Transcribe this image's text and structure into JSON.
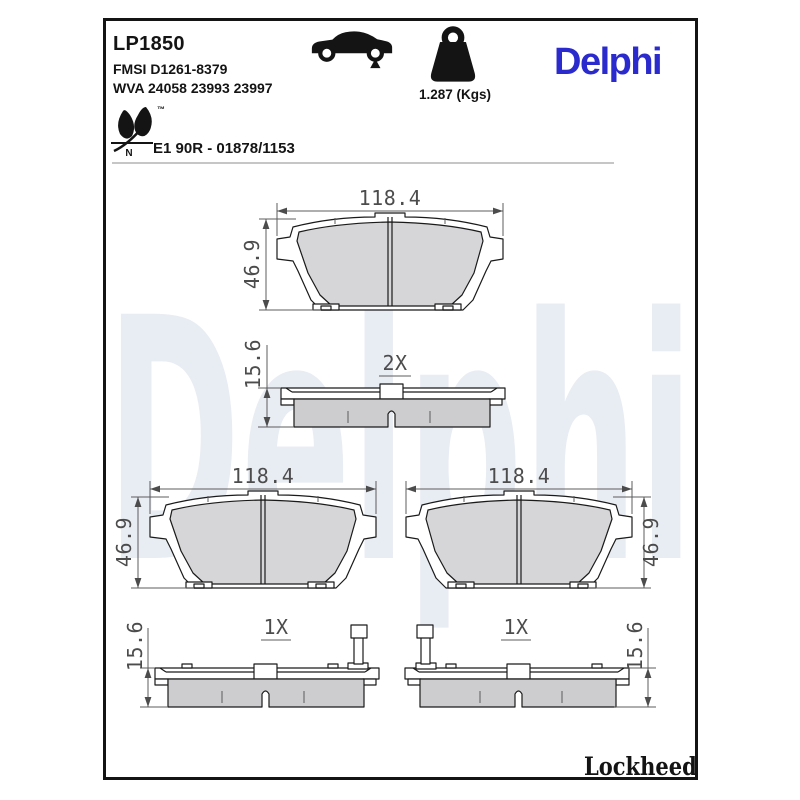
{
  "header": {
    "part_number": "LP1850",
    "fmsi_code": "FMSI D1261-8379",
    "wva_code": "WVA 24058 23993 23997",
    "weight": "1.287 (Kgs)",
    "brand_logo": "Delphi",
    "approval_code": "E1 90R - 01878/1153",
    "eco_trademark": "™",
    "eco_letter": "N"
  },
  "watermark": {
    "text": "Delphi"
  },
  "footer": {
    "brand": "Lockheed",
    "registered_mark": "®"
  },
  "drawings": {
    "pad_views": [
      {
        "position": "top-center",
        "width_mm": "118.4",
        "height_mm": "46.9"
      },
      {
        "position": "bottom-left",
        "width_mm": "118.4",
        "height_mm": "46.9"
      },
      {
        "position": "bottom-right",
        "width_mm": "118.4",
        "height_mm": "46.9"
      }
    ],
    "profile_views": [
      {
        "position": "middle",
        "thickness_mm": "15.6",
        "quantity": "2X"
      },
      {
        "position": "bottom-left",
        "thickness_mm": "15.6",
        "quantity": "1X"
      },
      {
        "position": "bottom-right",
        "thickness_mm": "15.6",
        "quantity": "1X"
      }
    ]
  },
  "icons": {
    "car": "car-silhouette-icon with rear-axle marker triangle",
    "weight": "weight-kettlebell-icon",
    "eco": "leaf-eco-icon"
  },
  "colors": {
    "brand_blue": "#2B2BCD",
    "watermark_gray": "#E8ECF3",
    "friction_fill": "#D6D6D8",
    "outline": "#1A1A1A"
  }
}
